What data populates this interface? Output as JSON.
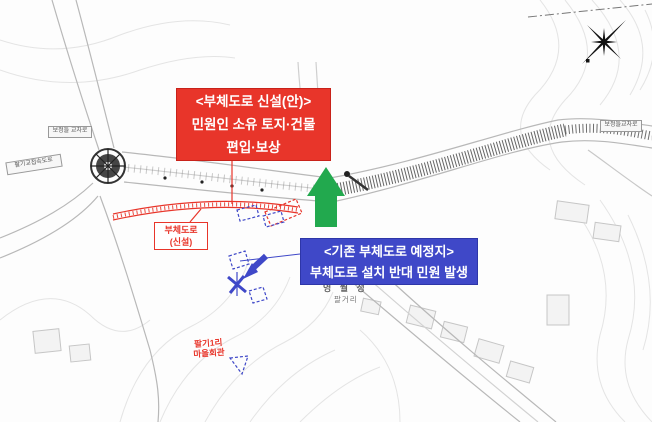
{
  "colors": {
    "red": "#e8352a",
    "red-dark": "#c8221a",
    "blue": "#3f48c8",
    "green": "#22a94e",
    "map-line": "#b8b8b8",
    "map-dark": "#4a4a4a",
    "contour": "#e4e4e4"
  },
  "callouts": {
    "proposed_side_road": {
      "line1": "<부체도로 신설(안)>",
      "line2": "민원인 소유 토지·건물",
      "line3": "편입·보상"
    },
    "existing_side_road": {
      "line1": "<기존 부체도로 예정지>",
      "line2": "부체도로 설치 반대 민원 발생"
    },
    "road_label": {
      "line1": "부체도로",
      "line2": "(신설)"
    }
  },
  "map_labels": {
    "intersection_left": "보정들 교차로",
    "access_road": "팔기교접속도로",
    "intersection_right": "보정들교차로",
    "pavilion": "영 월 정",
    "pavilion_sub": "팔거리",
    "village_hall_line1": "팔기1리",
    "village_hall_line2": "마을회관"
  },
  "icons": {
    "compass": "compass-rose-icon",
    "roundabout": "roundabout-symbol",
    "green_arrow": "up-arrow-marker",
    "blue_flag": "survey-mark-icon"
  }
}
